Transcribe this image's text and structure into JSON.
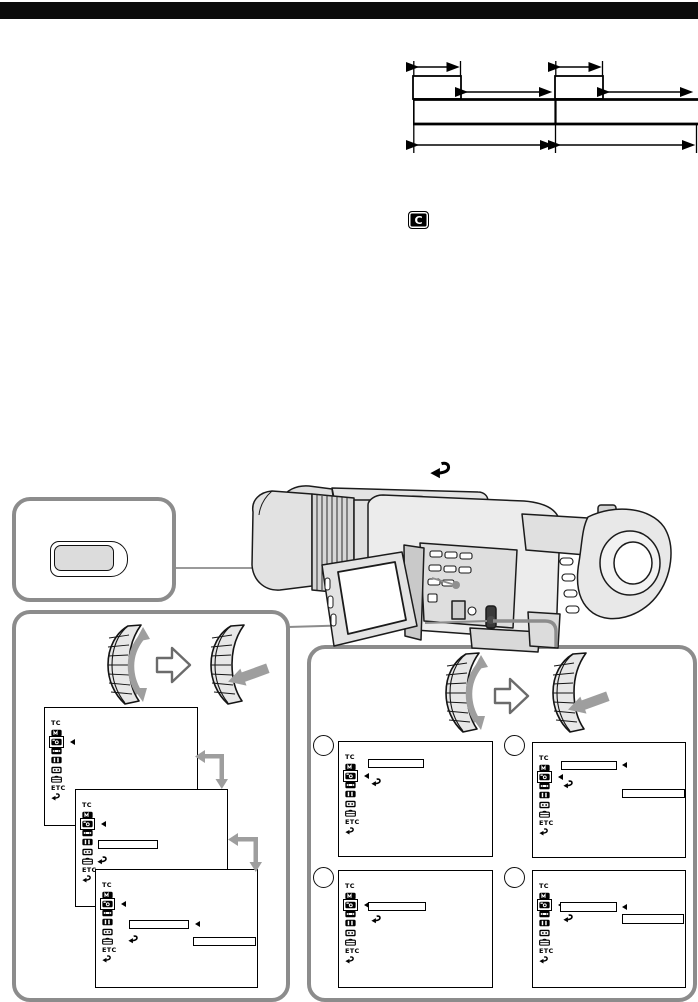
{
  "page": {
    "width": 698,
    "height": 1002,
    "background": "#ffffff",
    "header_bar_color": "#0b0b0b"
  },
  "colors": {
    "box_border": "#8c8c8c",
    "arrow_gray": "#9e9e9e",
    "line_black": "#000000",
    "button_fill": "#dcdcdc"
  },
  "icons": {
    "cassette_memory_label": "C"
  },
  "menu": {
    "selected_index": 2,
    "icons": [
      {
        "name": "tc-label",
        "label": "TC"
      },
      {
        "name": "manual-set-icon",
        "label": ""
      },
      {
        "name": "camera-set-icon",
        "label": ""
      },
      {
        "name": "vcr-set-icon",
        "label": ""
      },
      {
        "name": "lcd-vf-set-icon",
        "label": ""
      },
      {
        "name": "cm-set-icon",
        "label": ""
      },
      {
        "name": "tape-set-icon",
        "label": ""
      },
      {
        "name": "etc-label",
        "label": "ETC"
      },
      {
        "name": "return-icon",
        "label": ""
      }
    ]
  },
  "screens": [
    {
      "id": "L1",
      "x": 44,
      "y": 707,
      "w": 154,
      "h": 119,
      "z": 2,
      "overlays": []
    },
    {
      "id": "L2",
      "x": 75,
      "y": 789,
      "w": 153,
      "h": 118,
      "z": 3,
      "overlays": [
        {
          "type": "optbox",
          "x": 22,
          "y": 50,
          "w": 60,
          "h": 9
        },
        {
          "type": "return",
          "x": 21,
          "y": 66
        }
      ]
    },
    {
      "id": "L3",
      "x": 95,
      "y": 869,
      "w": 163,
      "h": 119,
      "z": 4,
      "overlays": [
        {
          "type": "optbox",
          "x": 33,
          "y": 50,
          "w": 60,
          "h": 9
        },
        {
          "type": "cursor",
          "x": 96,
          "y": 51
        },
        {
          "type": "return",
          "x": 32,
          "y": 65
        },
        {
          "type": "optbox",
          "x": 97,
          "y": 67,
          "w": 63,
          "h": 9
        }
      ]
    },
    {
      "id": "R1",
      "x": 338,
      "y": 741,
      "w": 155,
      "h": 116,
      "z": 2,
      "overlays": [
        {
          "type": "optbox",
          "x": 29,
          "y": 17,
          "w": 56,
          "h": 9
        },
        {
          "type": "return",
          "x": 32,
          "y": 36
        }
      ]
    },
    {
      "id": "R2",
      "x": 532,
      "y": 742,
      "w": 154,
      "h": 116,
      "z": 2,
      "overlays": [
        {
          "type": "optbox",
          "x": 28,
          "y": 18,
          "w": 56,
          "h": 9
        },
        {
          "type": "cursor",
          "x": 86,
          "y": 19
        },
        {
          "type": "return",
          "x": 30,
          "y": 37
        },
        {
          "type": "optbox",
          "x": 89,
          "y": 46,
          "w": 63,
          "h": 9
        }
      ]
    },
    {
      "id": "R3",
      "x": 338,
      "y": 870,
      "w": 155,
      "h": 118,
      "z": 2,
      "overlays": [
        {
          "type": "optbox",
          "x": 29,
          "y": 31,
          "w": 58,
          "h": 9
        },
        {
          "type": "return",
          "x": 32,
          "y": 44
        }
      ]
    },
    {
      "id": "R4",
      "x": 532,
      "y": 870,
      "w": 154,
      "h": 118,
      "z": 2,
      "overlays": [
        {
          "type": "optbox",
          "x": 27,
          "y": 31,
          "w": 57,
          "h": 10
        },
        {
          "type": "cursor",
          "x": 86,
          "y": 33
        },
        {
          "type": "return",
          "x": 30,
          "y": 43
        },
        {
          "type": "optbox",
          "x": 89,
          "y": 43,
          "w": 62,
          "h": 10
        }
      ]
    }
  ],
  "step_circles": [
    {
      "x": 313,
      "y": 735,
      "label": ""
    },
    {
      "x": 504,
      "y": 735,
      "label": ""
    },
    {
      "x": 313,
      "y": 867,
      "label": ""
    },
    {
      "x": 504,
      "y": 867,
      "label": ""
    }
  ]
}
